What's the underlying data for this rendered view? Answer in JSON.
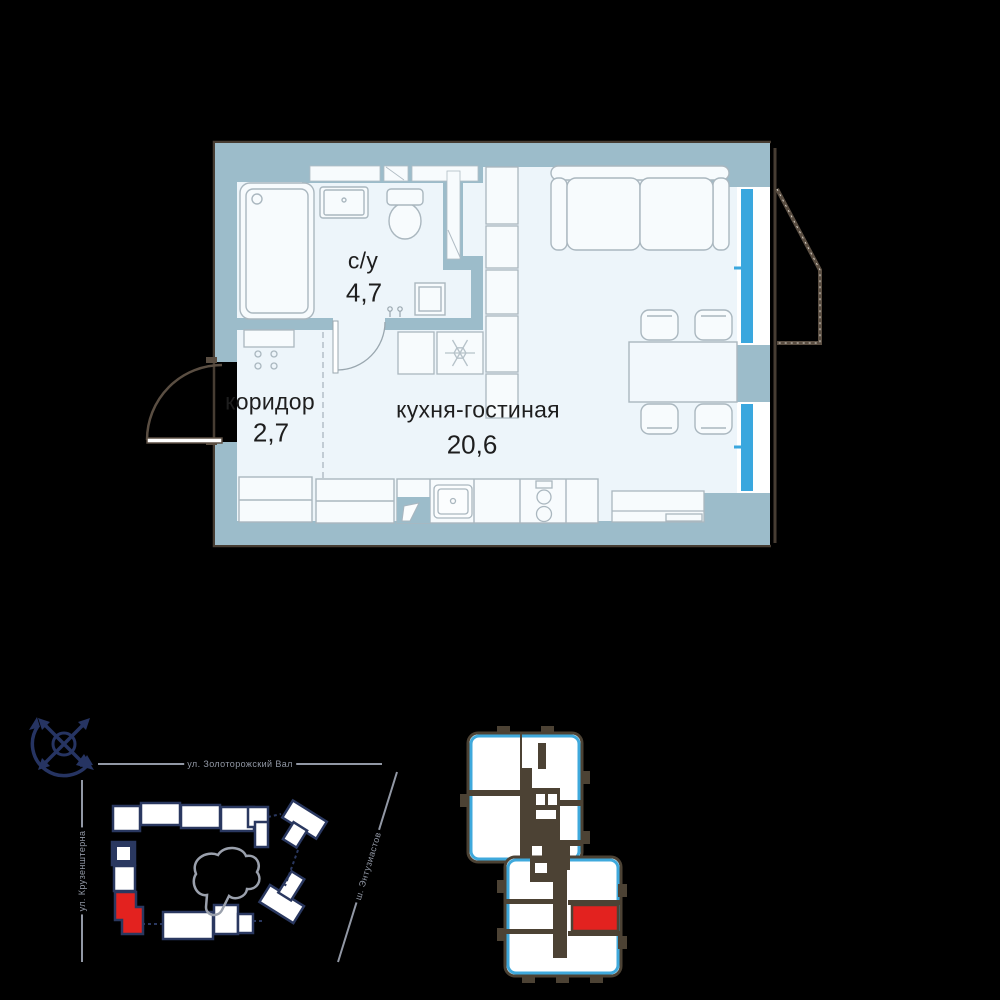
{
  "floor_plan": {
    "rooms": [
      {
        "name": "с/у",
        "area": "4,7"
      },
      {
        "name": "коридор",
        "area": "2,7"
      },
      {
        "name": "кухня-гостиная",
        "area": "20,6"
      }
    ]
  },
  "site_plan": {
    "streets": {
      "top": "ул. Золоторожский Вал",
      "left": "ул. Крузенштерна",
      "right": "ш. Энтузиастов"
    }
  },
  "colors": {
    "wall": "#9cbcca",
    "room_fill": "#edf5fa",
    "window_blue": "#3aa7de",
    "outline_dark": "#473d33",
    "balcony_brown": "#5a4e42",
    "navy": "#263462",
    "street_gray": "#9298a5",
    "highlight_red": "#e3221f"
  }
}
